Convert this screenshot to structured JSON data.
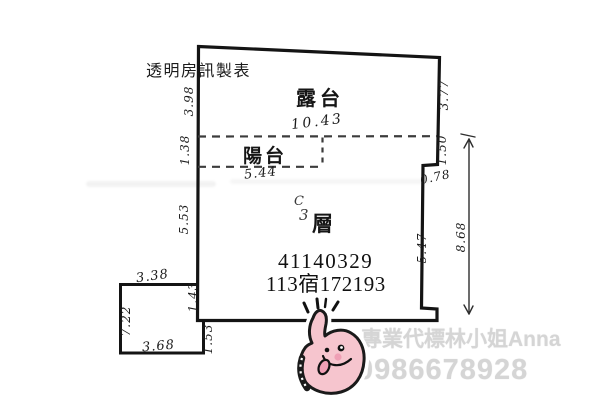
{
  "title_block": {
    "maker_label": "透明房訊製表"
  },
  "floorplan": {
    "room_labels": {
      "terrace": "露台",
      "balcony": "陽台",
      "unit_letter": "C",
      "floor_number": "3",
      "floor_word": "層"
    },
    "case_numbers": {
      "line1": "41140329",
      "line2": "113宿172193"
    },
    "dimensions": {
      "terrace_width": "10.43",
      "balcony_width": "5.44",
      "left_upper": "3.98",
      "left_balcony": "1.38",
      "left_middle": "5.53",
      "left_lower": "1.43",
      "annex_top": "3.38",
      "annex_left": "7.22",
      "annex_bottom": "3.68",
      "annex_right": "1.53",
      "right_upper": "3.77",
      "right_notch": "1.50",
      "right_notch_depth": "0.78",
      "right_lower": "5.47",
      "right_overall": "8.68"
    }
  },
  "watermark": {
    "agent_name": "專業代標林小姐Anna",
    "phone": "0986678928"
  },
  "sticker": {
    "icon": "thumbs-up-hand-face-sticker"
  },
  "colors": {
    "wall": "#141414",
    "dimension_text": "#1c1c1c",
    "watermark_gray": "#d5d5d5",
    "sticker_pink": "#f6c5ce",
    "sticker_accent": "#ef9fb5"
  }
}
